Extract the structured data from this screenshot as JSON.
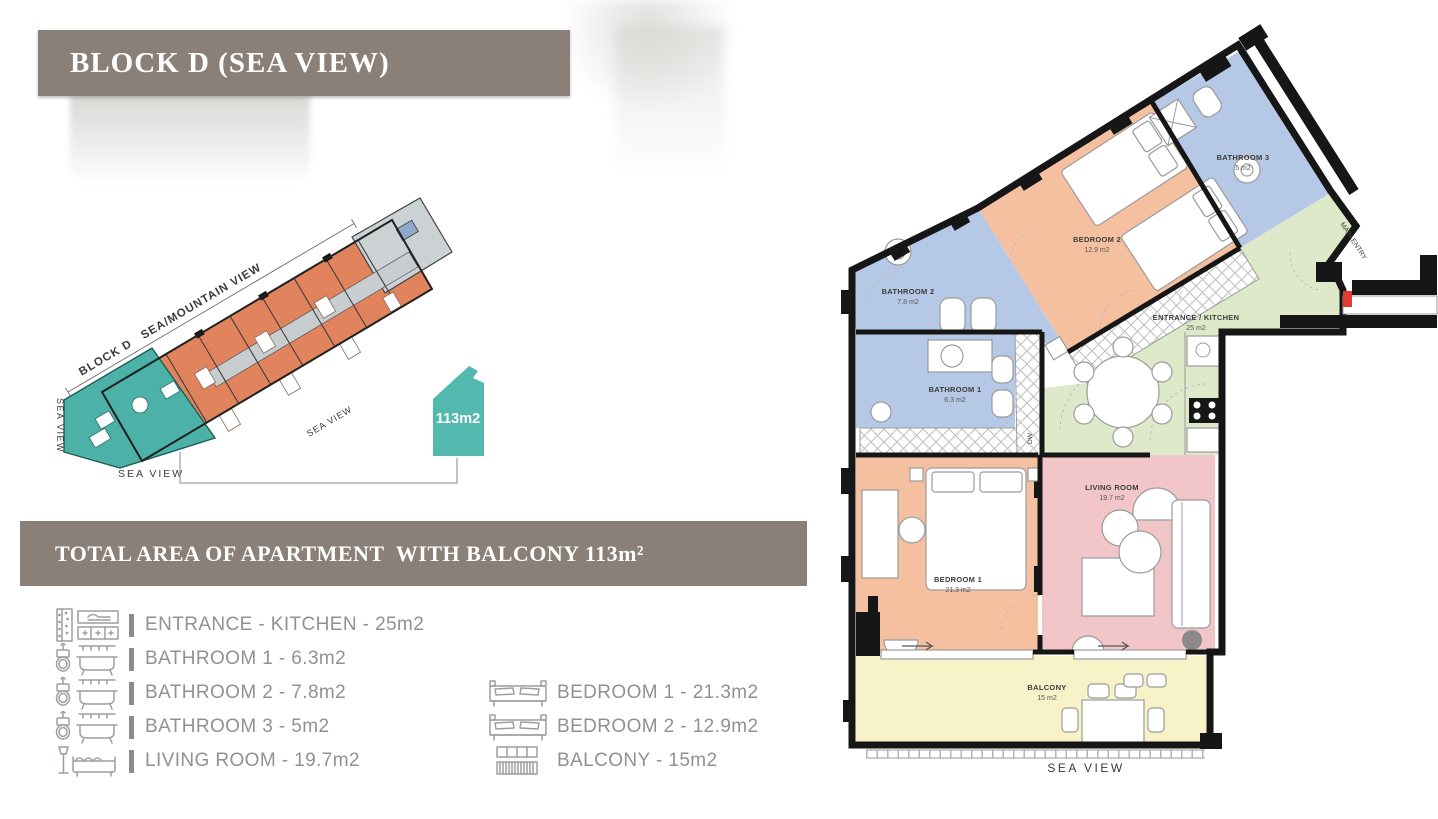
{
  "header": {
    "title": "BLOCK D (SEA VIEW)"
  },
  "summary_bar": {
    "text": "TOTAL AREA OF APARTMENT  WITH BALCONY 113m²"
  },
  "site_plan": {
    "block_line_label": "BLOCK D   SEA/MOUNTAIN VIEW",
    "sea_view_left": "SEA VIEW",
    "sea_view_bottom": "SEA VIEW",
    "sea_view_diagonal": "SEA VIEW",
    "highlight_badge": "113m2"
  },
  "legend": {
    "left": [
      {
        "icon": "entrance-kitchen",
        "label": "ENTRANCE - KITCHEN - 25m2"
      },
      {
        "icon": "bathroom",
        "label": "BATHROOM 1 - 6.3m2"
      },
      {
        "icon": "bathroom",
        "label": "BATHROOM 2 - 7.8m2"
      },
      {
        "icon": "bathroom",
        "label": "BATHROOM 3 - 5m2"
      },
      {
        "icon": "living-room",
        "label": "LIVING ROOM - 19.7m2"
      }
    ],
    "right": [
      {
        "icon": "bed",
        "label": "BEDROOM 1 - 21.3m2"
      },
      {
        "icon": "bed",
        "label": "BEDROOM 2 - 12.9m2"
      },
      {
        "icon": "balcony",
        "label": "BALCONY - 15m2"
      }
    ]
  },
  "floor_plan": {
    "rooms": {
      "bathroom2": {
        "name": "BATHROOM 2",
        "area": "7.8 m2"
      },
      "bathroom1": {
        "name": "BATHROOM 1",
        "area": "6.3 m2"
      },
      "bedroom2": {
        "name": "BEDROOM 2",
        "area": "12.9 m2"
      },
      "bathroom3": {
        "name": "BATHROOM 3",
        "area": "5 m2"
      },
      "entrance_kitchen": {
        "name": "ENTRANCE / KITCHEN",
        "area": "25 m2"
      },
      "living_room": {
        "name": "LIVING ROOM",
        "area": "19.7 m2"
      },
      "bedroom1": {
        "name": "BEDROOM 1",
        "area": "21.3 m2"
      },
      "balcony": {
        "name": "BALCONY",
        "area": "15 m2"
      }
    },
    "main_entry_label": "MAIN ENTRY",
    "sea_view_label": "SEA VIEW",
    "dw_label": "DW"
  },
  "colors": {
    "bar_brown": "#8a8077",
    "highlight_teal": "#4cb2a7",
    "unit_orange": "#e1835d",
    "room_blue": "#b5c8e6",
    "room_salmon": "#f4c0a0",
    "room_green": "#dee9ca",
    "room_pink": "#f2c6c8",
    "room_yellow": "#f8f2c8",
    "wall_black": "#161616",
    "entry_red": "#e23b30"
  }
}
